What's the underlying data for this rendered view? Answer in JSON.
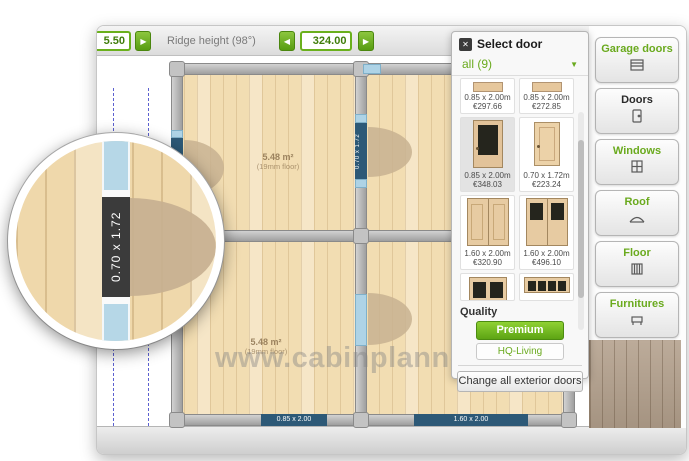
{
  "toolbar": {
    "left_spinner": {
      "value": "5.50"
    },
    "ridge": {
      "label": "Ridge height (98°)",
      "value": "324.00"
    }
  },
  "door_panel": {
    "title": "Select door",
    "close_icon": "close-icon",
    "filter_selected": "all (9)",
    "items": [
      {
        "size": "0.85 x 2.00m",
        "price": "€297.66"
      },
      {
        "size": "0.85 x 2.00m",
        "price": "€272.85"
      },
      {
        "size": "0.85 x 2.00m",
        "price": "€348.03"
      },
      {
        "size": "0.70 x 1.72m",
        "price": "€223.24"
      },
      {
        "size": "1.60 x 2.00m",
        "price": "€320.90"
      },
      {
        "size": "1.60 x 2.00m",
        "price": "€496.10"
      }
    ],
    "quality_label": "Quality",
    "premium_button": "Premium",
    "hq_living_button": "HQ-Living",
    "change_all_button": "Change all exterior doors"
  },
  "sidebar": {
    "items": [
      {
        "label": "Garage doors",
        "icon": "garage-door-icon",
        "active": false
      },
      {
        "label": "Doors",
        "icon": "door-icon",
        "active": true
      },
      {
        "label": "Windows",
        "icon": "window-icon",
        "active": false
      },
      {
        "label": "Roof",
        "icon": "roof-icon",
        "active": false
      },
      {
        "label": "Floor",
        "icon": "floor-icon",
        "active": false
      },
      {
        "label": "Furnitures",
        "icon": "furniture-icon",
        "active": false
      }
    ]
  },
  "plan": {
    "rooms": [
      {
        "area": "5.48 m²",
        "floor_note": "(19mm floor)"
      },
      {
        "area": "5.48 m²",
        "floor_note": "(19mm floor)"
      }
    ],
    "door_labels": {
      "inner_wall_door": "0.70 x 1.72",
      "left_wall_door": "0.70 x 1.72",
      "bottom_left_opening": "0.85 x 2.00",
      "bottom_right_opening": "1.60 x 2.00"
    },
    "watermark": "www.cabinplanner.com"
  },
  "magnifier": {
    "door_label": "0.70 x 1.72"
  },
  "colors": {
    "accent_green": "#62a814",
    "label_navy": "#2d5977",
    "wood_floor": "#f1dcb0",
    "door_marker_blue": "#aed3e6"
  }
}
